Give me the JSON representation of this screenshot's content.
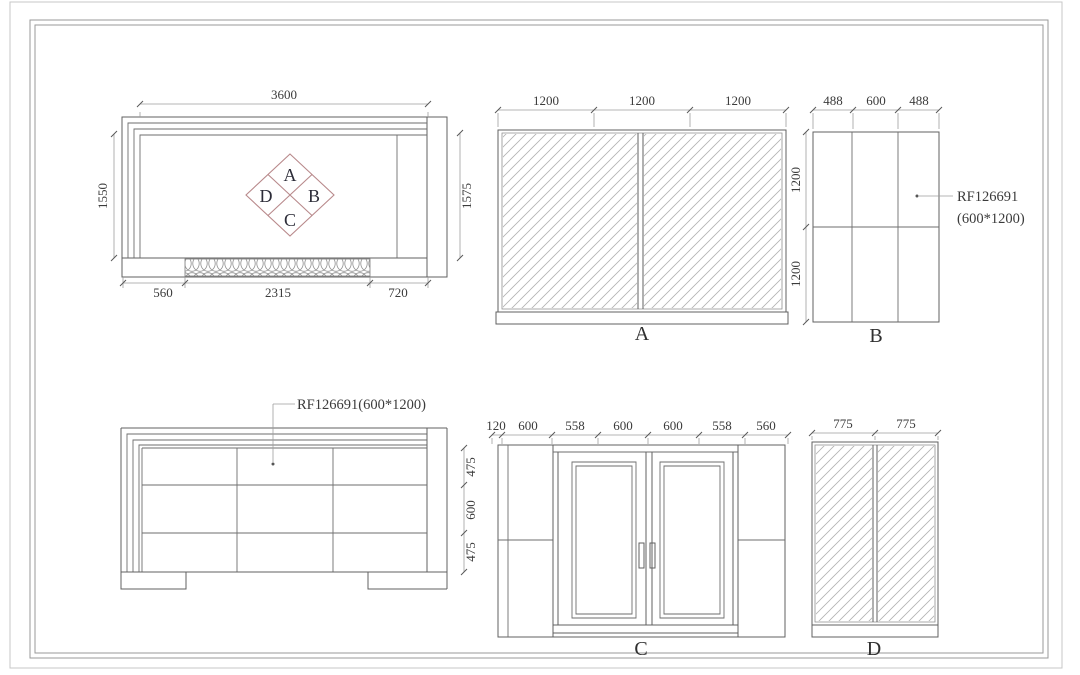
{
  "plan": {
    "dim_top": "3600",
    "dim_left": "1550",
    "dim_right": "1575",
    "dims_bottom": [
      "560",
      "2315",
      "720"
    ],
    "diamond": {
      "top": "A",
      "right": "B",
      "bottom": "C",
      "left": "D"
    }
  },
  "view_a": {
    "label": "A",
    "dims_top": [
      "1200",
      "1200",
      "1200"
    ]
  },
  "view_b": {
    "label": "B",
    "dims_top": [
      "488",
      "600",
      "488"
    ],
    "dims_left": [
      "1200",
      "1200"
    ],
    "note": {
      "line1": "RF126691",
      "line2": "(600*1200)"
    }
  },
  "elevation_front": {
    "note": "RF126691(600*1200)",
    "dims_right": [
      "475",
      "600",
      "475"
    ]
  },
  "view_c": {
    "label": "C",
    "dims_top": [
      "120",
      "600",
      "558",
      "600",
      "600",
      "558",
      "560"
    ]
  },
  "view_d": {
    "label": "D",
    "dims_top": [
      "775",
      "775"
    ]
  },
  "colors": {
    "line": "#616161",
    "diamond_accent": "#b8898b",
    "dim_text": "#3b3b3b"
  }
}
